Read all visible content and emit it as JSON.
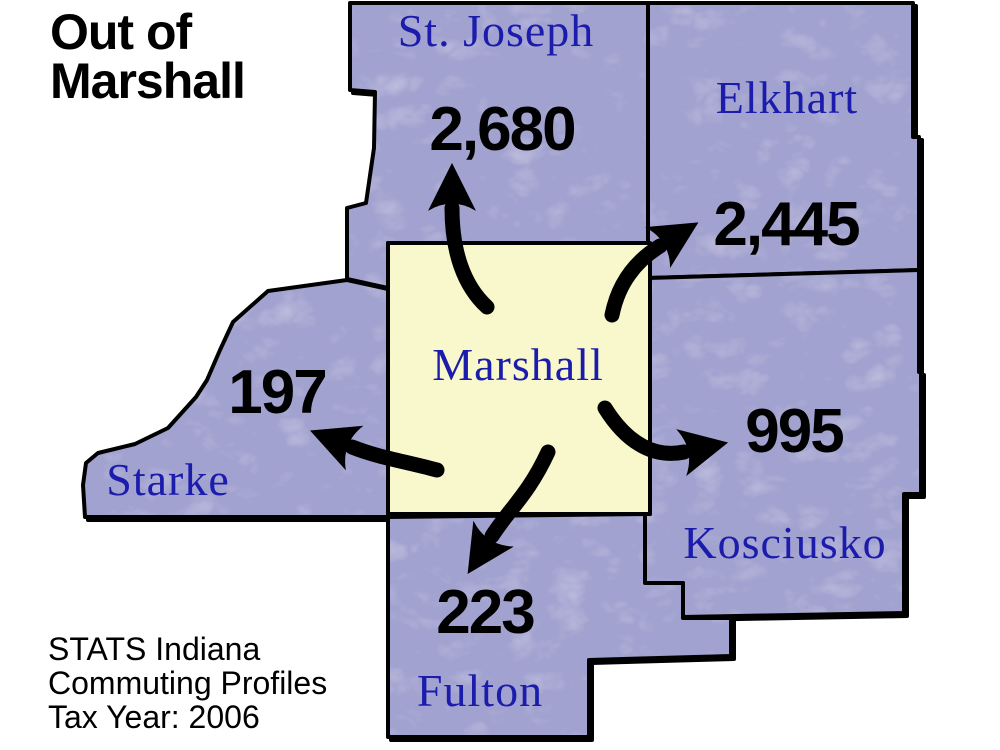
{
  "title": "Out of\nMarshall",
  "map": {
    "source_county": {
      "name": "Marshall"
    },
    "destinations": [
      {
        "name": "St. Joseph",
        "value": "2,680"
      },
      {
        "name": "Elkhart",
        "value": "2,445"
      },
      {
        "name": "Starke",
        "value": "197"
      },
      {
        "name": "Kosciusko",
        "value": "995"
      },
      {
        "name": "Fulton",
        "value": "223"
      }
    ]
  },
  "footer": {
    "lines": [
      "STATS Indiana",
      "Commuting Profiles",
      "Tax Year: 2006"
    ]
  },
  "colors": {
    "county_fill": "#a2a2d0",
    "marshall_fill": "#f8f8cc",
    "county_label": "#1b1bac",
    "value_text": "#000000",
    "arrow": "#000000",
    "border": "#000000",
    "background": "#ffffff"
  }
}
